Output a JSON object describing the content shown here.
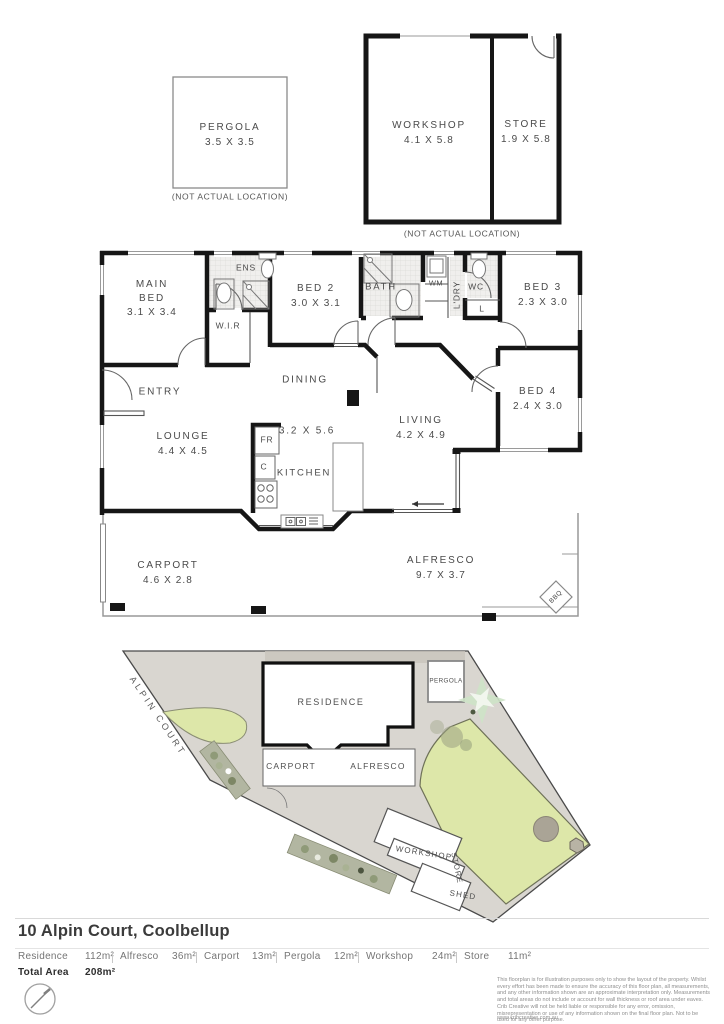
{
  "colors": {
    "wall": "#161616",
    "lawn": "#dde7a9",
    "lot_gray": "#d9d6d0",
    "label_gray": "#4a4a4a"
  },
  "top_plans": {
    "pergola": {
      "name": "PERGOLA",
      "dims": "3.5 X 3.5",
      "note": "(NOT ACTUAL LOCATION)"
    },
    "workshop": {
      "name": "WORKSHOP",
      "dims": "4.1 X 5.8"
    },
    "store": {
      "name": "STORE",
      "dims": "1.9 X 5.8"
    },
    "note": "(NOT ACTUAL LOCATION)"
  },
  "floor_plan": {
    "main_bed": {
      "l1": "MAIN",
      "l2": "BED",
      "dims": "3.1 X 3.4"
    },
    "ens": {
      "name": "ENS"
    },
    "wir": {
      "name": "W.I.R"
    },
    "bed2": {
      "name": "BED 2",
      "dims": "3.0 X 3.1"
    },
    "bath": {
      "name": "BATH"
    },
    "wm": {
      "name": "WM"
    },
    "ldry": {
      "name": "L'DRY"
    },
    "wc": {
      "name": "WC"
    },
    "linen": {
      "name": "L"
    },
    "bed3": {
      "name": "BED 3",
      "dims": "2.3 X 3.0"
    },
    "bed4": {
      "name": "BED 4",
      "dims": "2.4 X 3.0"
    },
    "entry": {
      "name": "ENTRY"
    },
    "dining": {
      "name": "DINING"
    },
    "lounge": {
      "name": "LOUNGE",
      "dims": "4.4 X 4.5"
    },
    "kitchen": {
      "name": "KITCHEN",
      "dims": "3.2 X 5.6"
    },
    "fridge": {
      "name": "FR"
    },
    "cupboard": {
      "name": "C"
    },
    "living": {
      "name": "LIVING",
      "dims": "4.2 X 4.9"
    },
    "carport": {
      "name": "CARPORT",
      "dims": "4.6 X 2.8"
    },
    "alfresco": {
      "name": "ALFRESCO",
      "dims": "9.7 X 3.7"
    },
    "bbq": {
      "name": "BBQ"
    }
  },
  "site_plan": {
    "street": "ALPIN COURT",
    "residence": "RESIDENCE",
    "carport": "CARPORT",
    "alfresco": "ALFRESCO",
    "pergola": "PERGOLA",
    "workshop": "WORKSHOP",
    "store": "STORE",
    "shed": "SHED"
  },
  "footer": {
    "address": "10 Alpin Court, Coolbellup",
    "areas": [
      {
        "label": "Residence",
        "value": "112m²"
      },
      {
        "label": "Alfresco",
        "value": "36m²"
      },
      {
        "label": "Carport",
        "value": "13m²"
      },
      {
        "label": "Pergola",
        "value": "12m²"
      },
      {
        "label": "Workshop",
        "value": "24m²"
      },
      {
        "label": "Store",
        "value": "11m²"
      }
    ],
    "total_label": "Total Area",
    "total_value": "208m²",
    "disclaimer": "This floorplan is for illustration purposes only to show the layout of the property. Whilst every effort has been made to ensure the accuracy of this floor plan, all measurements, and any other information shown are an approximate interpretation only. Measurements and total areas do not include or account for wall thickness or roof area under eaves. Crib Creative will not be held liable or responsible for any error, omission, misrepresentation or use of any information shown on the final floor plan. Not to be used for any other purpose.",
    "website": "www.cribcreative.com.au"
  }
}
